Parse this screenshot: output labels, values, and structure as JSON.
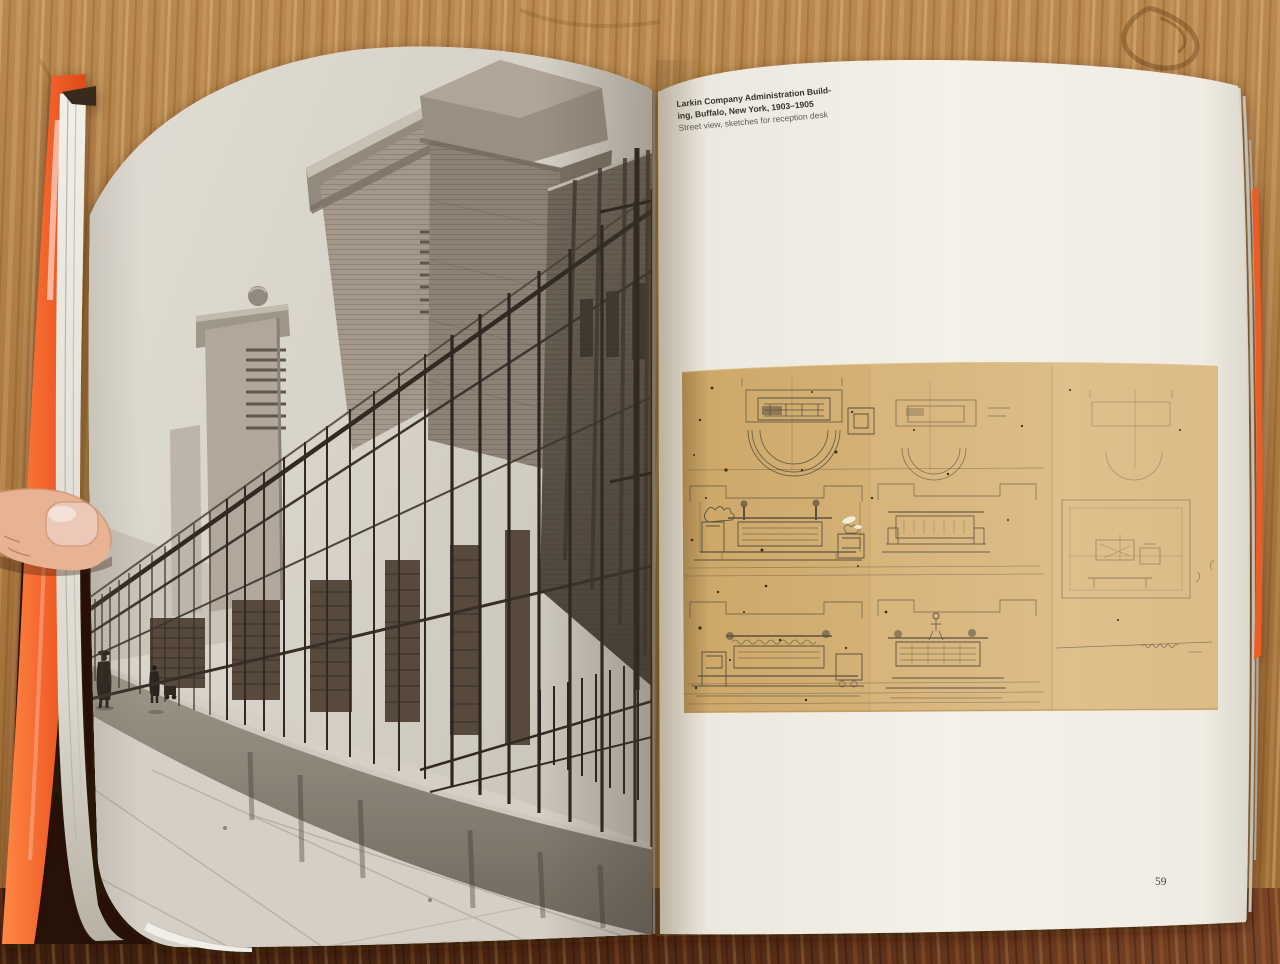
{
  "scene": {
    "alt": "Open architecture book lying on a wooden table, held by a thumb at the left edge"
  },
  "left_page": {
    "alt": "Black-and-white street photograph of the Larkin Administration Building brick towers behind a tall iron fence, concrete base wall and sidewalk with pedestrians"
  },
  "right_page": {
    "caption": {
      "line1": "Larkin Company Administration Build-",
      "line2": "ing, Buffalo, New York, 1903–1905",
      "line3": "Street view, sketches for reception desk"
    },
    "page_number": "59"
  },
  "sketch": {
    "alt": "Pencil sketches for the reception desk on tan paper: plan views with semicircular counters above, desk elevations below, small perspective study at right"
  },
  "colors": {
    "cover_orange": "#ee5a27",
    "table_wood_top": "#ad7b42",
    "table_wood_bottom": "#522a16",
    "page_white": "#f3f0e8",
    "sketch_paper": "#d6b277",
    "photo_dark": "#352e26",
    "photo_light": "#ddd8ce",
    "thumb_skin": "#e4ac8c"
  }
}
